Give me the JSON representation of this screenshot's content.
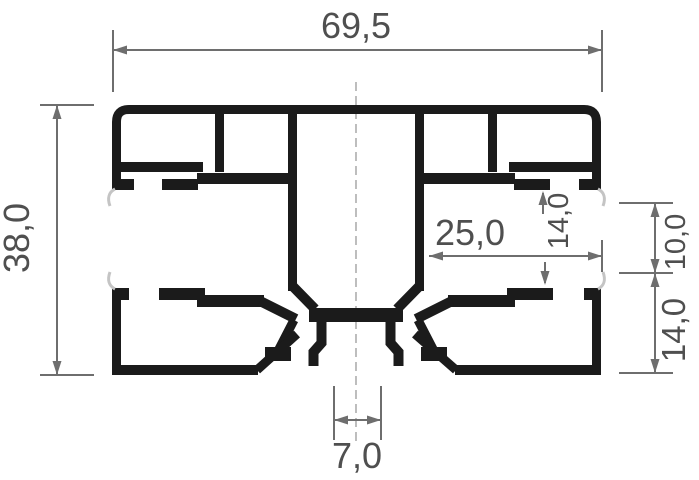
{
  "drawing": {
    "labels": {
      "overall_width": "69,5",
      "overall_height": "38,0",
      "inset_width": "25,0",
      "groove_gap": "14,0",
      "upper_right_gap": "10,0",
      "lower_right_height": "14,0",
      "bottom_slot_width": "7,0"
    },
    "colors": {
      "profile": "#1b1b1b",
      "dimension_lines": "#6e6e6e",
      "dimension_text": "#4f4f4f",
      "gasket": "#c4c4c4",
      "centerline": "#9a9a9a",
      "background": "#ffffff"
    }
  }
}
